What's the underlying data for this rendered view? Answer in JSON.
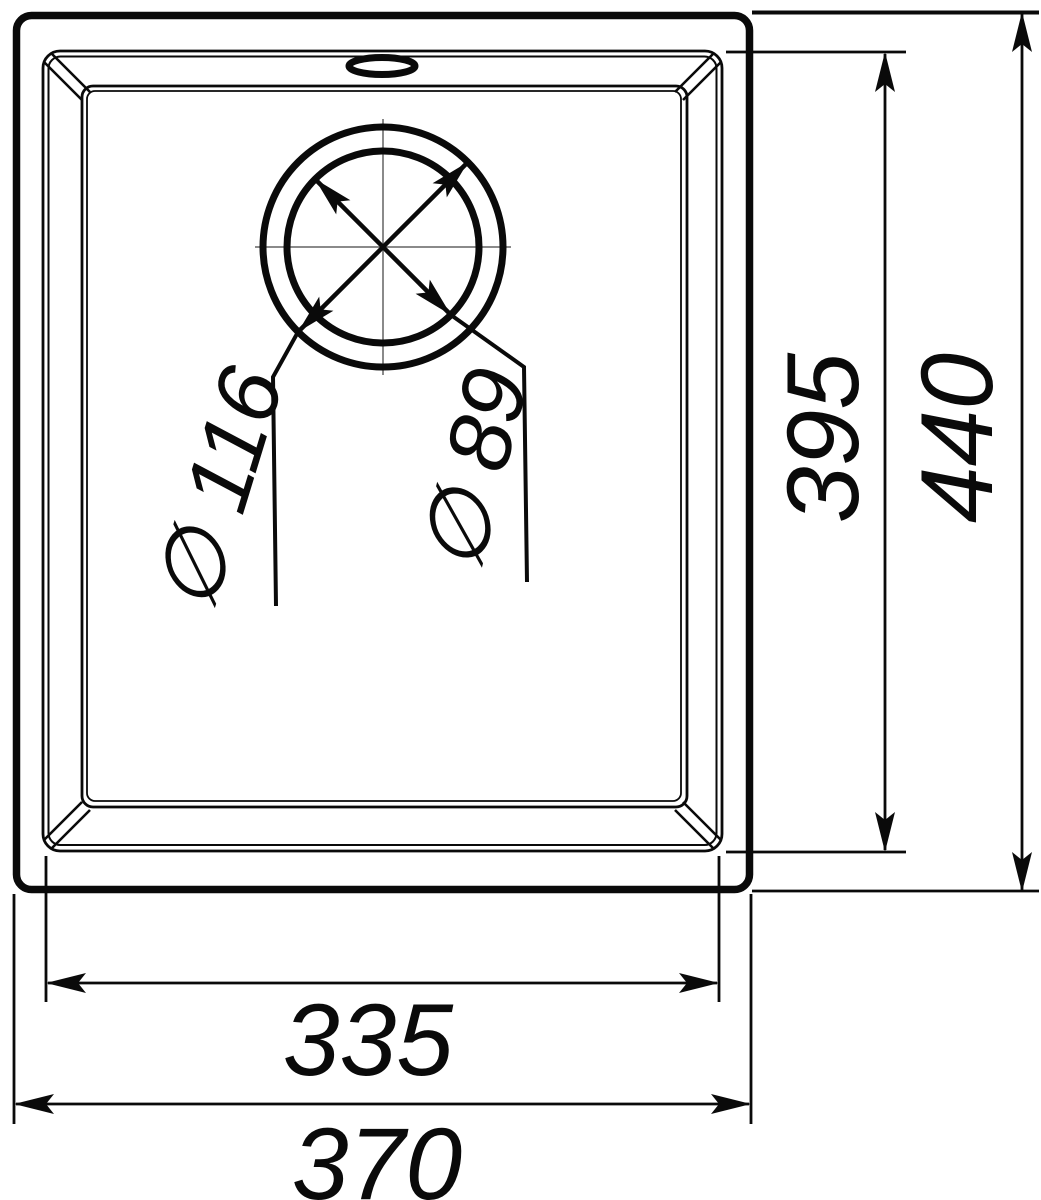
{
  "dimensions": {
    "inner_width_label": "335",
    "outer_width_label": "370",
    "inner_depth_label": "395",
    "outer_depth_label": "440",
    "drain_outer_diameter_label": "∅ 116",
    "drain_inner_diameter_label": "∅ 89"
  },
  "colors": {
    "line": "#0a0a0a",
    "centerline": "#8a8a8a",
    "background": "#ffffff"
  }
}
